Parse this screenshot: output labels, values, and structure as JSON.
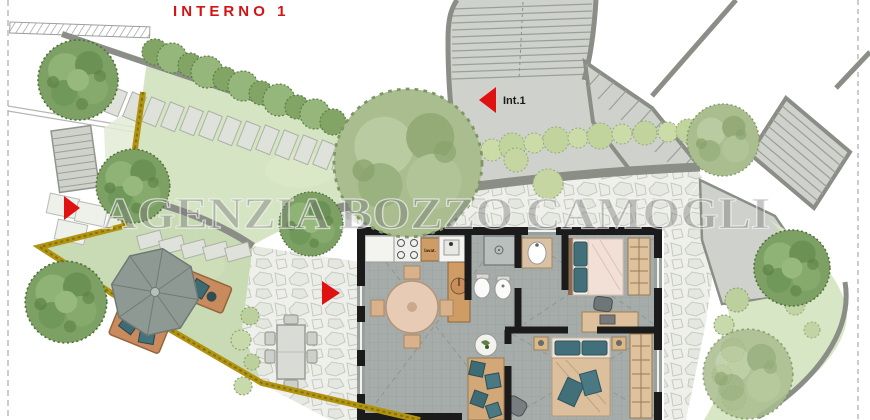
{
  "texts": {
    "title": "INTERNO 1",
    "watermark": "AGENZIA BOZZO CAMOGLI",
    "unit_label": "Int.1",
    "kitchen_label": "lavat."
  },
  "colors": {
    "title_red": "#d61313",
    "arrow_red": "#e01111",
    "boundary_yellow": "#b29413",
    "lawn_green": "#c8dbb4",
    "upper_garden_green": "#d5e4c2",
    "right_band_green": "#d7e6c4",
    "path_gray": "#8a8e86",
    "plaza_gray": "#cfd2cc",
    "floor_gray": "#a6acaa",
    "wall_dark": "#1b1b1b",
    "wood": "#cf9c66",
    "cushion_teal": "#3f6b74",
    "watermark_gray": "rgba(120,120,120,0.42)"
  },
  "markers": {
    "arrows": [
      {
        "name": "garden-access-arrow",
        "direction": "right"
      },
      {
        "name": "entrance-arrow",
        "direction": "right"
      },
      {
        "name": "int1-arrow",
        "direction": "left"
      }
    ]
  }
}
